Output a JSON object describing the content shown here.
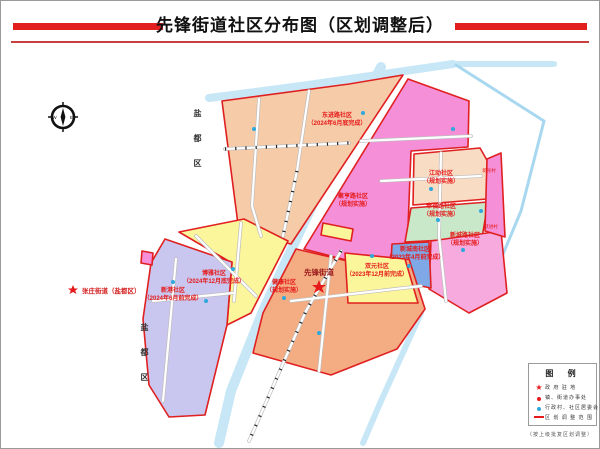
{
  "title": "先锋街道社区分布图（区划调整后）",
  "compass": {
    "west": "W",
    "east": "E"
  },
  "landmarks": {
    "yandu": "盐都区",
    "zhangzhuang": "张庄街道（盐都区）",
    "xianfeng": "先锋街道"
  },
  "regions": [
    {
      "name": "东进路社区",
      "status": "（2024年6月底完成）",
      "color": "#f6cba8"
    },
    {
      "name": "江动社区",
      "status": "（规划实施）",
      "color": "#f8dcc4"
    },
    {
      "name": "幸福路社区",
      "status": "（规划实施）",
      "color": "#c9e8c9"
    },
    {
      "name": "新城路社区",
      "status": "（规划实施）",
      "color": "#f6aade"
    },
    {
      "name": "新城南社区",
      "status": "（2023年4月前完成）",
      "color": "#7fa9e6"
    },
    {
      "name": "博雅社区",
      "status": "（2024年12月底完成）",
      "color": "#fbf59b"
    },
    {
      "name": "新港社区",
      "status": "（2024年6月前完成）",
      "color": "#c9c6ef"
    },
    {
      "name": "健康社区",
      "status": "（规划实施）",
      "color": "#f4ac82"
    },
    {
      "name": "双元社区",
      "status": "（2023年12月前完成）",
      "color": "#fbf59b"
    },
    {
      "name": "聚亨路社区",
      "status": "（规划实施）",
      "color": "#f48fd8"
    }
  ],
  "villages": [
    "新民村",
    "跃进村"
  ],
  "legend": {
    "title": "图  例",
    "items": [
      {
        "symbol": "star",
        "label": "政 府 驻 地"
      },
      {
        "symbol": "red-dot",
        "label": "镇、街道办事处"
      },
      {
        "symbol": "blue-dot",
        "label": "行政村、社区居委会"
      },
      {
        "symbol": "red-line",
        "label": "区 划 调 整 范 围"
      }
    ]
  },
  "caption": "（按上级批复区划调整）",
  "colors": {
    "accent_red": "#e31e1e",
    "river_blue": "#c7e7f7",
    "dot_blue": "#2fa8dc"
  }
}
